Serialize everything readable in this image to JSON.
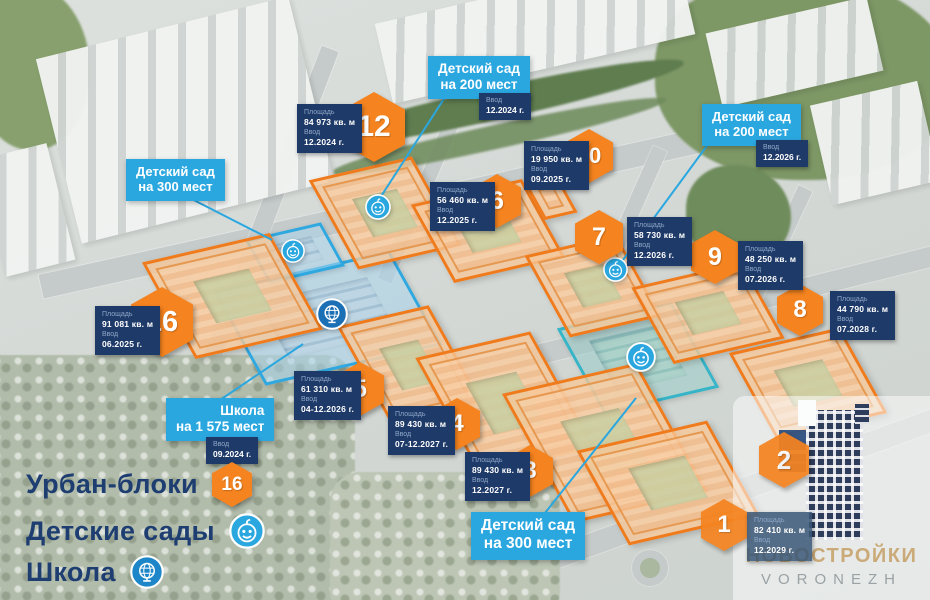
{
  "labels": {
    "area_label": "Площадь",
    "vvod_label": "Ввод"
  },
  "blocks": {
    "b1": {
      "num": "1",
      "area": "82 410 кв. м",
      "vvod": "12.2029 г."
    },
    "b2": {
      "num": "2"
    },
    "b3": {
      "num": "3",
      "area": "89 430 кв. м",
      "vvod": "12.2027 г."
    },
    "b4": {
      "num": "4",
      "area": "89 430 кв. м",
      "vvod": "07-12.2027 г."
    },
    "b5": {
      "num": "5",
      "area": "61 310 кв. м",
      "vvod": "04-12.2026 г."
    },
    "b6": {
      "num": "6",
      "area": "56 460 кв. м",
      "vvod": "12.2025 г."
    },
    "b7": {
      "num": "7",
      "area": "58 730 кв. м",
      "vvod": "12.2026 г."
    },
    "b8": {
      "num": "8",
      "area": "44 790 кв. м",
      "vvod": "07.2028 г."
    },
    "b9": {
      "num": "9",
      "area": "48 250 кв. м",
      "vvod": "07.2026 г."
    },
    "b10": {
      "num": "10",
      "area": "19 950 кв. м",
      "vvod": "09.2025 г."
    },
    "b12": {
      "num": "12",
      "area": "84 973 кв. м",
      "vvod": "12.2024 г."
    },
    "b16": {
      "num": "16",
      "area": "91 081 кв. м",
      "vvod": "06.2025 г."
    }
  },
  "callouts": {
    "kg200_top": {
      "line1": "Детский сад",
      "line2": "на 200 мест",
      "vvod": "12.2024 г."
    },
    "kg200_right": {
      "line1": "Детский сад",
      "line2": "на 200 мест",
      "vvod": "12.2026 г."
    },
    "kg300_left": {
      "line1": "Детский сад",
      "line2": "на 300 мест"
    },
    "kg300_bottom": {
      "line1": "Детский сад",
      "line2": "на 300 мест"
    },
    "school": {
      "line1": "Школа",
      "line2": "на 1 575 мест",
      "vvod": "09.2024 г."
    }
  },
  "legend": {
    "urban_blocks_label": "Урбан-блоки",
    "urban_blocks_count": "16",
    "kindergartens_label": "Детские сады",
    "school_label": "Школа"
  },
  "logo": {
    "brand": "НОВОСТРОЙКИ",
    "city": "VORONEZH"
  },
  "colors": {
    "accent_orange": "#f5831f",
    "accent_blue": "#2ba7e0",
    "teal": "#36b4c8",
    "navy": "#1e3a68"
  }
}
